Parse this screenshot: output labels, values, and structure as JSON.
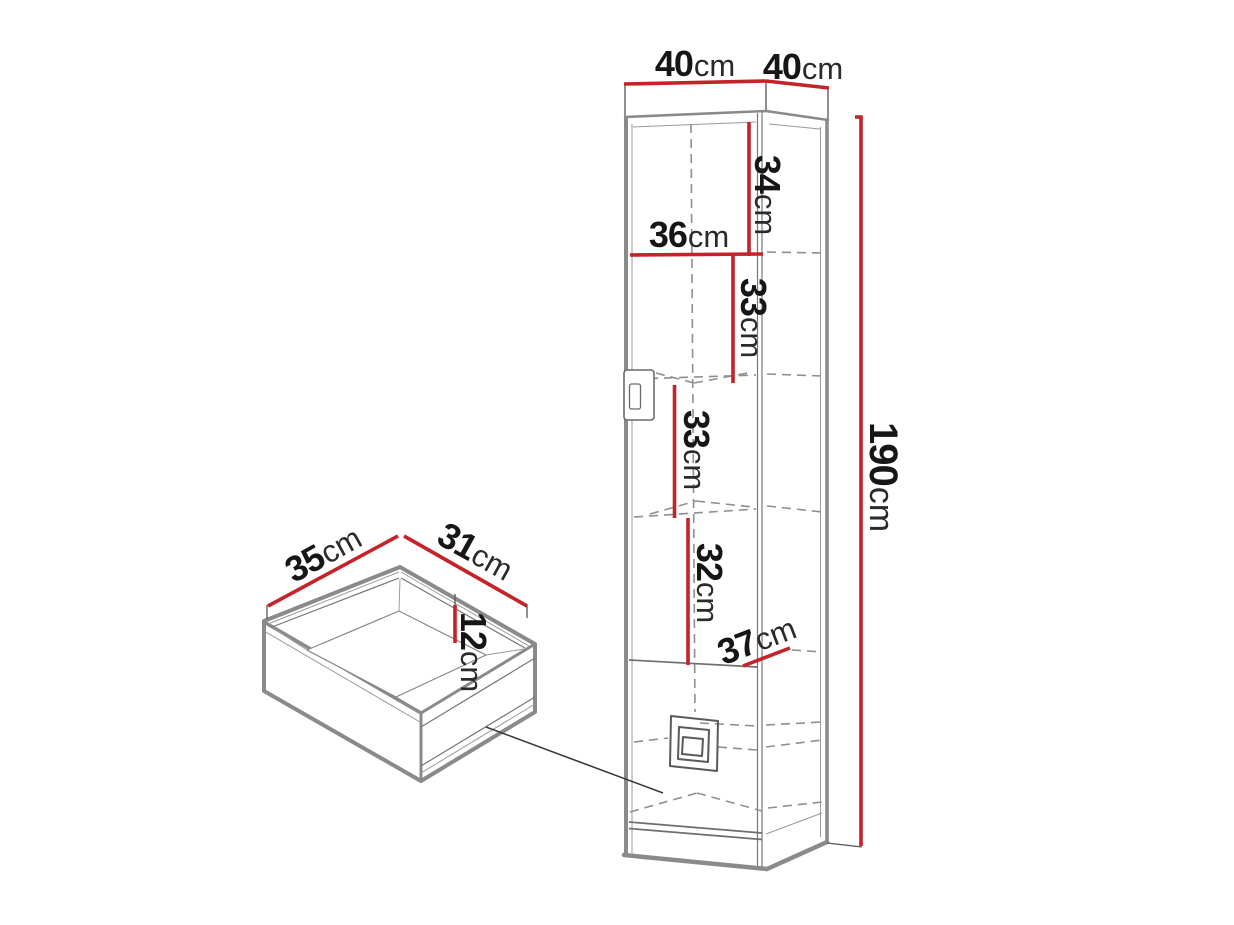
{
  "diagram": {
    "type": "furniture-dimension-diagram",
    "subject": "corner cabinet with drawer detail",
    "colors": {
      "background": "#ffffff",
      "dimension_accent": "#c4232a",
      "outline_gray": "#8a8a8a",
      "text": "#161616"
    },
    "dimensions": {
      "cabinet_top_width_left": {
        "value": "40",
        "unit": "cm"
      },
      "cabinet_top_width_right": {
        "value": "40",
        "unit": "cm"
      },
      "cabinet_height": {
        "value": "190",
        "unit": "cm"
      },
      "top_section_height": {
        "value": "34",
        "unit": "cm"
      },
      "top_section_width": {
        "value": "36",
        "unit": "cm"
      },
      "second_section_height": {
        "value": "33",
        "unit": "cm"
      },
      "third_section_height": {
        "value": "33",
        "unit": "cm"
      },
      "fourth_section_height": {
        "value": "32",
        "unit": "cm"
      },
      "bottom_section_width": {
        "value": "37",
        "unit": "cm"
      },
      "drawer_depth": {
        "value": "35",
        "unit": "cm"
      },
      "drawer_width": {
        "value": "31",
        "unit": "cm"
      },
      "drawer_inner_height": {
        "value": "12",
        "unit": "cm"
      }
    }
  }
}
